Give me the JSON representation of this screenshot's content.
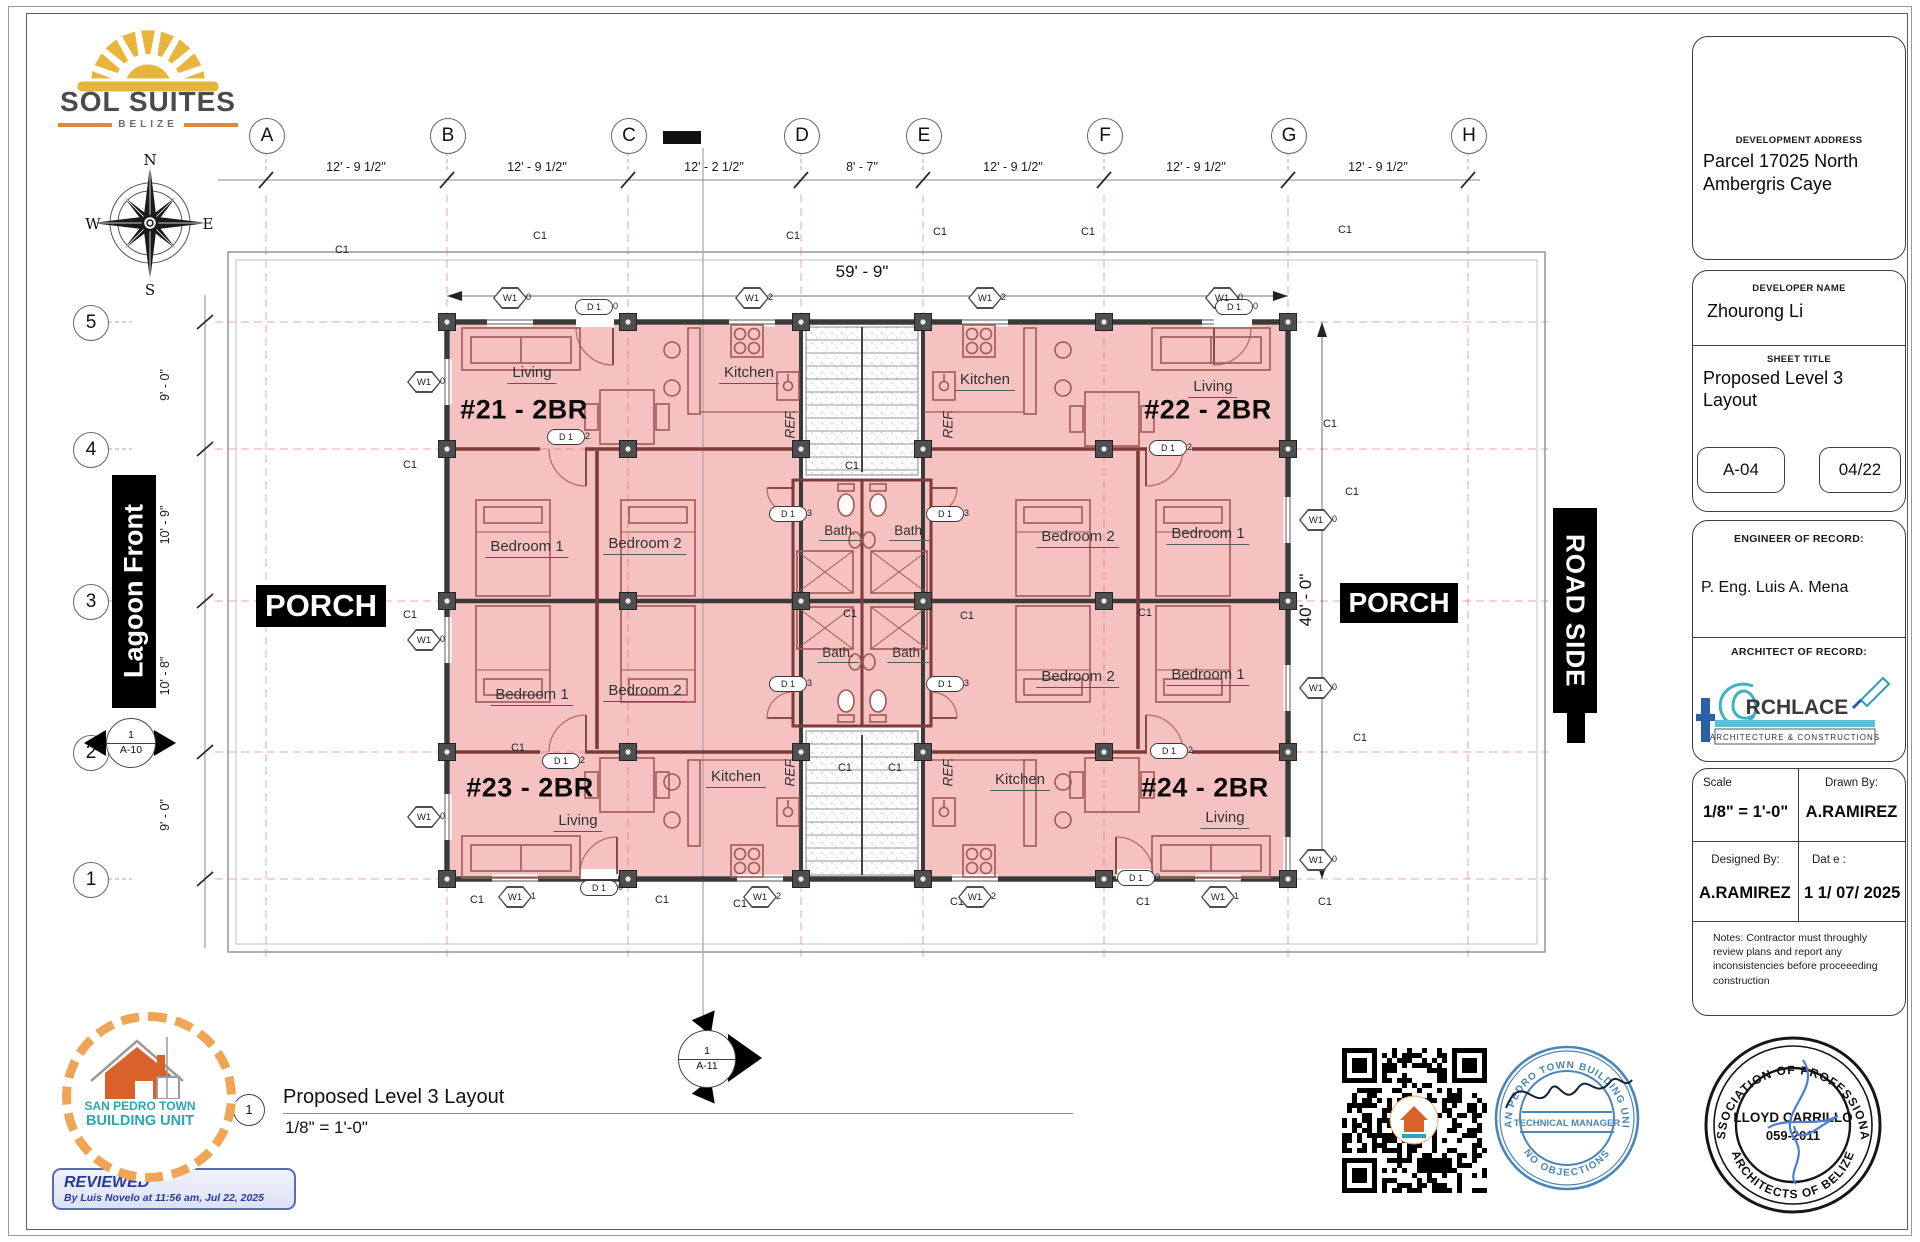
{
  "brand": {
    "name": "SOL SUITES",
    "sub": "BELIZE"
  },
  "compass": {
    "n": "N",
    "e": "E",
    "s": "S",
    "w": "W"
  },
  "grid": {
    "cols": [
      "A",
      "B",
      "C",
      "D",
      "E",
      "F",
      "G",
      "H"
    ],
    "col_dims": [
      "12' - 9 1/2\"",
      "12' - 9 1/2\"",
      "12' - 2 1/2\"",
      "8' - 7\"",
      "12' - 9 1/2\"",
      "12' - 9 1/2\"",
      "12' - 9 1/2\""
    ],
    "rows": [
      "5",
      "4",
      "3",
      "2",
      "1"
    ],
    "row_dims": [
      "9' - 0\"",
      "10' - 9\"",
      "10' - 8\"",
      "9' - 0\""
    ]
  },
  "plan": {
    "overall_width": "59' - 9\"",
    "overall_depth": "40' - 0\"",
    "left_banner": "Lagoon Front",
    "right_banner": "ROAD SIDE",
    "porch": "PORCH",
    "units": [
      "#21 - 2BR",
      "#22 - 2BR",
      "#23 - 2BR",
      "#24 - 2BR"
    ],
    "rooms": {
      "living": "Living",
      "kitchen": "Kitchen",
      "bed1": "Bedroom 1",
      "bed2": "Bedroom 2",
      "bath": "Bath.",
      "ref": "REF."
    },
    "markers": {
      "column": "C1",
      "window": "W1",
      "door": "D 1"
    },
    "window_tags": [
      "0",
      "1",
      "2"
    ],
    "door_tags": [
      "0",
      "2",
      "3"
    ],
    "sections": {
      "left_num": "1",
      "left_sheet": "A-10",
      "bottom_num": "1",
      "bottom_sheet": "A-11"
    }
  },
  "titleblock": {
    "address_label": "DEVELOPMENT ADDRESS",
    "address": "Parcel 17025 North Ambergris Caye",
    "developer_label": "DEVELOPER NAME",
    "developer": "Zhourong Li",
    "sheet_label": "SHEET TITLE",
    "sheet_title": "Proposed Level 3 Layout",
    "sheet_no": "A-04",
    "revision": "04/22",
    "engineer_label": "ENGINEER OF RECORD:",
    "engineer": "P. Eng. Luis A. Mena",
    "architect_label": "ARCHITECT OF RECORD:",
    "architect_firm": "RCHLACE",
    "architect_sub": "ARCHITECTURE & CONSTRUCTIONS",
    "scale_label": "Scale",
    "scale": "1/8\" = 1'-0\"",
    "drawn_label": "Drawn By:",
    "drawn_by": "A.RAMIREZ",
    "designed_label": "Designed By:",
    "designed_by": "A.RAMIREZ",
    "date_label": "Dat e :",
    "date": "1 1/ 07/ 2025",
    "notes": "Notes: Contractor must throughly review plans and report any inconsistencies before proceeeding construction"
  },
  "view_title": {
    "num": "1",
    "title": "Proposed Level 3 Layout",
    "scale": "1/8\" = 1'-0\""
  },
  "review": {
    "title": "REVIEWED",
    "subtitle": "By Luis Novelo at 11:56 am, Jul 22, 2025"
  },
  "sp_logo": {
    "line1": "SAN PEDRO TOWN",
    "line2": "BUILDING UNIT"
  },
  "stamps": {
    "bu_arc_top": "SAN PEDRO TOWN  BUILDING UNIT",
    "bu_band": "TECHNICAL MANAGER",
    "bu_arc_bottom": "NO OBJECTIONS",
    "ar_arc_top": "ASSOCIATION OF PROFESSIONAL",
    "ar_arc_bottom": "ARCHITECTS OF BELIZE",
    "ar_name": "LLOYD CARRILLO",
    "ar_number": "059-2011"
  }
}
